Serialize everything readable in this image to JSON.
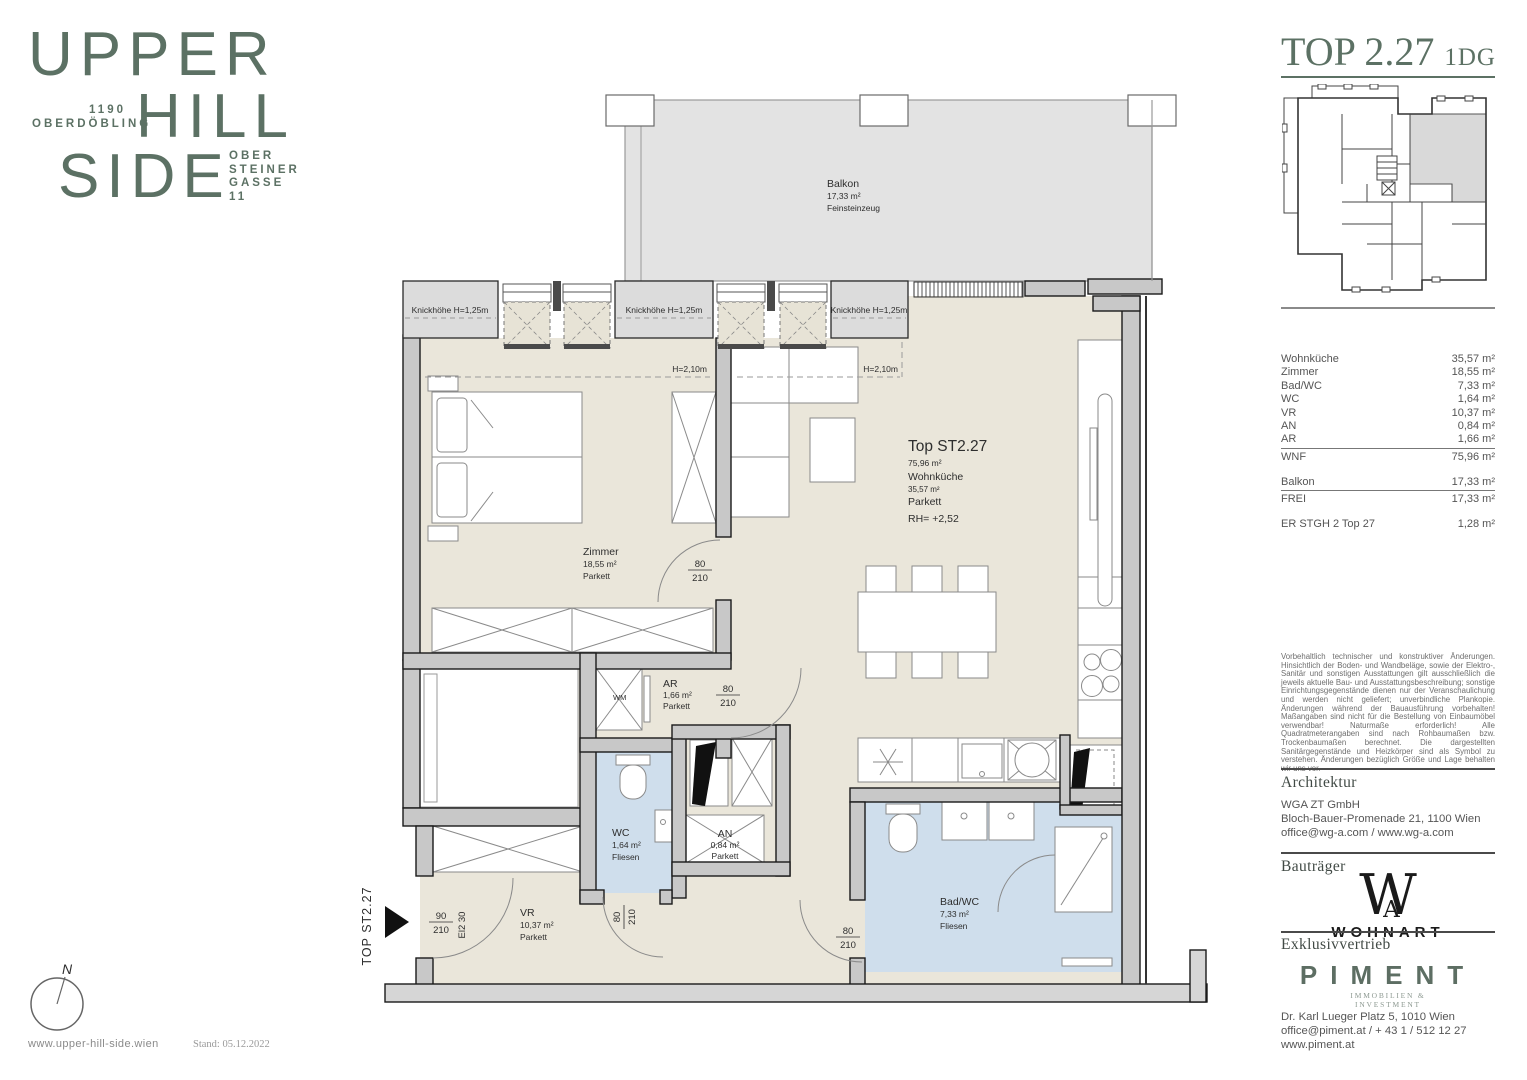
{
  "branding": {
    "line1": "UPPER",
    "line2": "HILL",
    "line3": "SIDE",
    "district_line1": "1190",
    "district_line2": "OBERDÖBLING",
    "address_line1": "OBER",
    "address_line2": "STEINER",
    "address_line3": "GASSE",
    "address_line4": "11",
    "accent_color": "#5c7164"
  },
  "header": {
    "title": "TOP 2.27",
    "floor_tag": "1DG"
  },
  "area_table": {
    "rows": [
      {
        "label": "Wohnküche",
        "value": "35,57 m²"
      },
      {
        "label": "Zimmer",
        "value": "18,55 m²"
      },
      {
        "label": "Bad/WC",
        "value": "7,33 m²"
      },
      {
        "label": "WC",
        "value": "1,64 m²"
      },
      {
        "label": "VR",
        "value": "10,37 m²"
      },
      {
        "label": "AN",
        "value": "0,84 m²"
      },
      {
        "label": "AR",
        "value": "1,66 m²"
      }
    ],
    "wnf": {
      "label": "WNF",
      "value": "75,96 m²"
    },
    "balkon": {
      "label": "Balkon",
      "value": "17,33 m²"
    },
    "frei": {
      "label": "FREI",
      "value": "17,33 m²"
    },
    "extra": {
      "label": "ER STGH 2 Top 27",
      "value": "1,28 m²"
    }
  },
  "disclaimer": "Vorbehaltlich technischer und konstruktiver Änderungen. Hinsichtlich der Boden- und Wandbeläge, sowie der Elektro-, Sanitär und sonstigen Ausstattungen gilt ausschließlich die jeweils aktuelle Bau- und Ausstattungsbeschreibung; sonstige Einrichtungsgegenstände dienen nur der Veranschaulichung und werden nicht geliefert; unverbindliche Plankopie. Änderungen während der Bauausführung vorbehalten! Maßangaben sind nicht für die Bestellung von Einbaumöbel verwendbar! Naturmaße erforderlich! Alle Quadratmeterangaben sind nach Rohbaumaßen bzw. Trockenbaumaßen berechnet. Die dargestellten Sanitärgegenstände und Heizkörper sind als Symbol zu verstehen. Änderungen bezüglich Größe und Lage behalten wir uns vor.",
  "architektur": {
    "heading": "Architektur",
    "company": "WGA ZT GmbH",
    "address": "Bloch-Bauer-Promenade 21, 1100 Wien",
    "contact": "office@wg-a.com / www.wg-a.com"
  },
  "bautraeger": {
    "heading": "Bauträger",
    "monogram_w": "W",
    "monogram_a": "A",
    "name": "WOHNART"
  },
  "vertrieb": {
    "heading": "Exklusivvertrieb",
    "name": "PIMENT",
    "tagline1": "IMMOBILIEN &",
    "tagline2": "INVESTMENT",
    "address": "Dr. Karl Lueger Platz 5, 1010 Wien",
    "contact": "office@piment.at / + 43 1 / 512 12 27",
    "website": "www.piment.at"
  },
  "footer": {
    "website": "www.upper-hill-side.wien",
    "stand": "Stand: 05.12.2022",
    "compass_label": "N"
  },
  "plan": {
    "colors": {
      "floor_beige": "#eae6da",
      "floor_blue": "#cfdeec",
      "balcony_gray": "#e3e3e3",
      "wall_gray": "#c8c8c8",
      "knick_gray": "#dcdcdc"
    },
    "balkon": {
      "name": "Balkon",
      "area": "17,33 m²",
      "floor": "Feinsteinzeug"
    },
    "wohnkueche": {
      "title": "Top ST2.27",
      "total_area": "75,96 m²",
      "name": "Wohnküche",
      "area": "35,57 m²",
      "floor": "Parkett",
      "rh": "RH= +2,52"
    },
    "zimmer": {
      "name": "Zimmer",
      "area": "18,55 m²",
      "floor": "Parkett"
    },
    "ar": {
      "name": "AR",
      "area": "1,66 m²",
      "floor": "Parkett"
    },
    "wc": {
      "name": "WC",
      "area": "1,64 m²",
      "floor": "Fliesen"
    },
    "an": {
      "name": "AN",
      "area": "0,84 m²",
      "floor": "Parkett"
    },
    "vr": {
      "name": "VR",
      "area": "10,37 m²",
      "floor": "Parkett"
    },
    "bad": {
      "name": "Bad/WC",
      "area": "7,33 m²",
      "floor": "Fliesen"
    },
    "knick_label": "Knickhöhe H=1,25m",
    "h210_label": "H=2,10m",
    "door_w": "80",
    "door_h": "210",
    "entry_w": "90",
    "entry_h": "210",
    "entry_class": "El2 30",
    "wm_label": "WM",
    "unit_tag": "TOP ST2.27"
  }
}
